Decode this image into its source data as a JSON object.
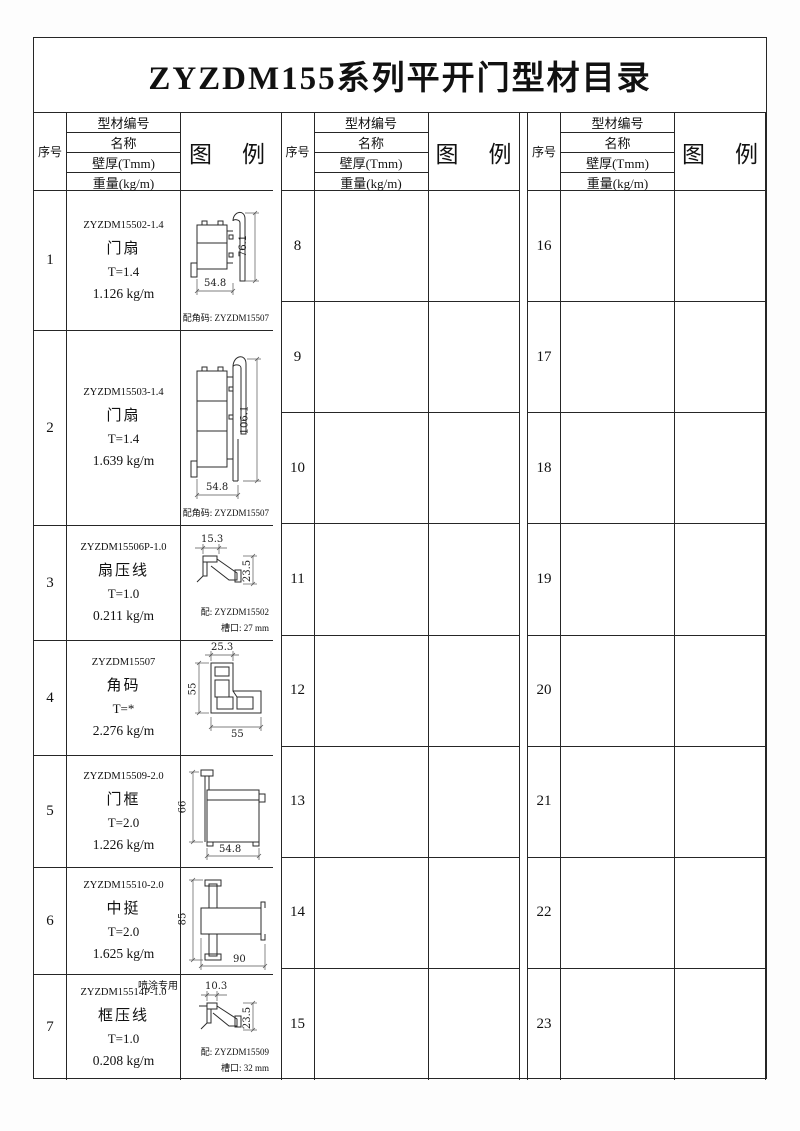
{
  "title": "ZYZDM155系列平开门型材目录",
  "header": {
    "serial": "序号",
    "code": "型材编号",
    "name": "名称",
    "thickness": "壁厚(Tmm)",
    "weight": "重量(kg/m)",
    "legend_left": "图",
    "legend_right": "例"
  },
  "left_rows": [
    {
      "sn": "1",
      "code": "ZYZDM15502-1.4",
      "name": "门扇",
      "thickness": "T=1.4",
      "weight": "1.126 kg/m",
      "dims": {
        "right": "76.1",
        "bottom": "54.8"
      },
      "notes": [
        "配角码: ZYZDM15507"
      ]
    },
    {
      "sn": "2",
      "code": "ZYZDM15503-1.4",
      "name": "门扇",
      "thickness": "T=1.4",
      "weight": "1.639 kg/m",
      "dims": {
        "right": "106.1",
        "bottom": "54.8"
      },
      "notes": [
        "配角码: ZYZDM15507"
      ]
    },
    {
      "sn": "3",
      "code": "ZYZDM15506P-1.0",
      "name": "扇压线",
      "thickness": "T=1.0",
      "weight": "0.211 kg/m",
      "dims": {
        "top": "15.3",
        "right": "23.5"
      },
      "notes": [
        "配: ZYZDM15502",
        "槽口: 27 mm"
      ]
    },
    {
      "sn": "4",
      "code": "ZYZDM15507",
      "name": "角码",
      "thickness": "T=*",
      "weight": "2.276 kg/m",
      "dims": {
        "top": "25.3",
        "left": "55",
        "bottom": "55"
      },
      "notes": []
    },
    {
      "sn": "5",
      "code": "ZYZDM15509-2.0",
      "name": "门框",
      "thickness": "T=2.0",
      "weight": "1.226 kg/m",
      "dims": {
        "left": "66",
        "bottom": "54.8"
      },
      "notes": []
    },
    {
      "sn": "6",
      "code": "ZYZDM15510-2.0",
      "name": "中挺",
      "thickness": "T=2.0",
      "weight": "1.625 kg/m",
      "dims": {
        "left": "85",
        "bottom": "90"
      },
      "notes": []
    },
    {
      "sn": "7",
      "code": "ZYZDM15514P-1.0",
      "name": "框压线",
      "thickness": "T=1.0",
      "weight": "0.208 kg/m",
      "dims": {
        "top": "10.3",
        "right": "23.5"
      },
      "notes": [
        "配: ZYZDM15509",
        "槽口: 32 mm"
      ],
      "annotation": "喷涂专用"
    }
  ],
  "middle_rows": [
    {
      "sn": "8"
    },
    {
      "sn": "9"
    },
    {
      "sn": "10"
    },
    {
      "sn": "11"
    },
    {
      "sn": "12"
    },
    {
      "sn": "13"
    },
    {
      "sn": "14"
    },
    {
      "sn": "15"
    }
  ],
  "right_rows": [
    {
      "sn": "16"
    },
    {
      "sn": "17"
    },
    {
      "sn": "18"
    },
    {
      "sn": "19"
    },
    {
      "sn": "20"
    },
    {
      "sn": "21"
    },
    {
      "sn": "22"
    },
    {
      "sn": "23"
    }
  ],
  "colors": {
    "line": "#262626",
    "ink": "#111111",
    "paper": "#ffffff"
  }
}
